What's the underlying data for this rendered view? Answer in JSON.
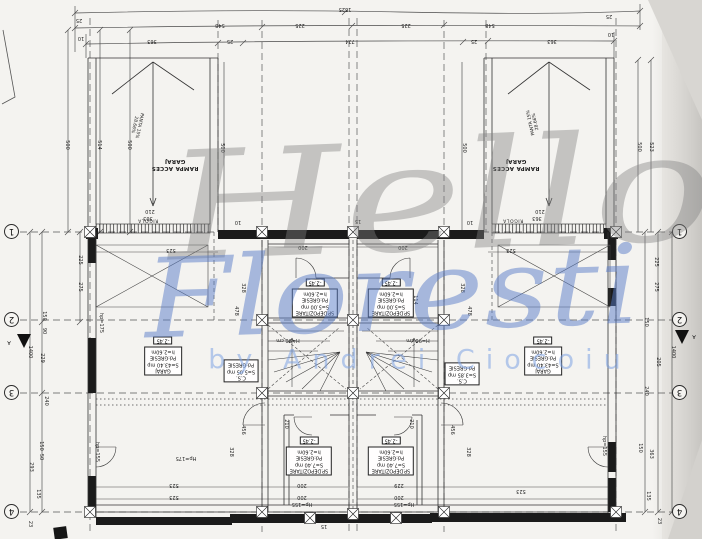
{
  "watermark": {
    "word1": "Hello",
    "word2": "Floresti",
    "byline": "by Andrei Ciocoiu"
  },
  "axes": {
    "left": [
      "1",
      "2",
      "3",
      "4"
    ],
    "right": [
      "1",
      "2",
      "3",
      "4"
    ]
  },
  "ramps": {
    "left": {
      "name1": "RAMPA ACCES",
      "name2": "GARAJ",
      "slope1": "PANTA 15%",
      "slope2": "28.66%",
      "channel": "RIGOLA"
    },
    "right": {
      "name1": "RAMPA ACCES",
      "name2": "GARAJ",
      "slope1": "PANTA 15%",
      "slope2": "28.66%",
      "channel": "RIGOLA"
    }
  },
  "room_labels": [
    {
      "id": "garage-left",
      "x": 163,
      "y": 356,
      "level": "-2.45",
      "lines": [
        "GARAJ",
        "S=43.40 mp",
        "Pd:GRESIE",
        "h=2.60m"
      ]
    },
    {
      "id": "garage-right",
      "x": 543,
      "y": 356,
      "level": "-2.45",
      "lines": [
        "GARAJ",
        "S=43.40 mp",
        "Pd:GRESIE",
        "h=2.60m"
      ]
    },
    {
      "id": "storage-upper-left",
      "x": 315,
      "y": 298,
      "level": "-2.45",
      "lines": [
        "SP.DEPOZITARE",
        "S=5.00 mp",
        "Pd:GRESIE",
        "h=2.60m"
      ]
    },
    {
      "id": "storage-upper-right",
      "x": 391,
      "y": 298,
      "level": "-2.45",
      "lines": [
        "SP.DEPOZITARE",
        "S=5.00 mp",
        "Pd:GRESIE",
        "h=2.60m"
      ]
    },
    {
      "id": "storage-lower-left",
      "x": 309,
      "y": 456,
      "level": "-2.45",
      "lines": [
        "SP.DEPOZITARE",
        "S=7.40 mp",
        "Pd:GRESIE",
        "h=2.60m"
      ]
    },
    {
      "id": "storage-lower-right",
      "x": 391,
      "y": 456,
      "level": "-2.45",
      "lines": [
        "SP.DEPOZITARE",
        "S=7.40 mp",
        "Pd:GRESIE",
        "h=2.60m"
      ]
    },
    {
      "id": "stair-left",
      "x": 241,
      "y": 371,
      "level": "",
      "lines": [
        "C.S.",
        "S=5.05 mp",
        "Pd:GRESIE"
      ]
    },
    {
      "id": "stair-right",
      "x": 462,
      "y": 374,
      "level": "",
      "lines": [
        "C.S.",
        "S=3.85 mp",
        "Pd:GRESIE"
      ]
    }
  ],
  "annotations": [
    {
      "t": "1525",
      "x": 345,
      "y": 9,
      "r": 180
    },
    {
      "t": "25",
      "x": 79,
      "y": 20,
      "r": 180
    },
    {
      "t": "10",
      "x": 81,
      "y": 38,
      "r": 180
    },
    {
      "t": "548",
      "x": 220,
      "y": 25,
      "r": 180
    },
    {
      "t": "225",
      "x": 300,
      "y": 25,
      "r": 180
    },
    {
      "t": "225",
      "x": 406,
      "y": 25,
      "r": 180
    },
    {
      "t": "548",
      "x": 490,
      "y": 25,
      "r": 180
    },
    {
      "t": "363",
      "x": 152,
      "y": 41,
      "r": 180
    },
    {
      "t": "25",
      "x": 230,
      "y": 41,
      "r": 180
    },
    {
      "t": "774",
      "x": 350,
      "y": 41,
      "r": 180
    },
    {
      "t": "25",
      "x": 474,
      "y": 41,
      "r": 180
    },
    {
      "t": "363",
      "x": 552,
      "y": 41,
      "r": 180
    },
    {
      "t": "25",
      "x": 609,
      "y": 16,
      "r": 180
    },
    {
      "t": "10",
      "x": 611,
      "y": 34,
      "r": 180
    },
    {
      "t": "500",
      "x": 67,
      "y": 145,
      "r": 90
    },
    {
      "t": "514",
      "x": 99,
      "y": 145,
      "r": 90
    },
    {
      "t": "500",
      "x": 129,
      "y": 145,
      "r": 90
    },
    {
      "t": "500",
      "x": 222,
      "y": 148,
      "r": 90
    },
    {
      "t": "500",
      "x": 464,
      "y": 148,
      "r": 90
    },
    {
      "t": "500",
      "x": 639,
      "y": 147,
      "r": 90
    },
    {
      "t": "523",
      "x": 651,
      "y": 147,
      "r": 90
    },
    {
      "t": "210",
      "x": 150,
      "y": 211,
      "r": 180
    },
    {
      "t": "363",
      "x": 148,
      "y": 218,
      "r": 180
    },
    {
      "t": "210",
      "x": 540,
      "y": 211,
      "r": 180
    },
    {
      "t": "363",
      "x": 537,
      "y": 218,
      "r": 180
    },
    {
      "t": "225",
      "x": 80,
      "y": 260,
      "r": 90
    },
    {
      "t": "275",
      "x": 80,
      "y": 287,
      "r": 90
    },
    {
      "t": "1400",
      "x": 30,
      "y": 352,
      "r": 90
    },
    {
      "t": "150",
      "x": 44,
      "y": 316,
      "r": 90
    },
    {
      "t": "90",
      "x": 44,
      "y": 331,
      "r": 90
    },
    {
      "t": "229",
      "x": 42,
      "y": 358,
      "r": 90
    },
    {
      "t": "240",
      "x": 46,
      "y": 401,
      "r": 90
    },
    {
      "t": "150",
      "x": 41,
      "y": 446,
      "r": 90
    },
    {
      "t": "50",
      "x": 41,
      "y": 457,
      "r": 90
    },
    {
      "t": "293",
      "x": 31,
      "y": 467,
      "r": 90
    },
    {
      "t": "135",
      "x": 38,
      "y": 494,
      "r": 90
    },
    {
      "t": "23",
      "x": 30,
      "y": 524,
      "r": 90
    },
    {
      "t": "225",
      "x": 656,
      "y": 262,
      "r": 90
    },
    {
      "t": "275",
      "x": 656,
      "y": 287,
      "r": 90
    },
    {
      "t": "1400",
      "x": 673,
      "y": 352,
      "r": 90
    },
    {
      "t": "150",
      "x": 646,
      "y": 322,
      "r": 90
    },
    {
      "t": "205",
      "x": 658,
      "y": 362,
      "r": 90
    },
    {
      "t": "240",
      "x": 646,
      "y": 391,
      "r": 90
    },
    {
      "t": "363",
      "x": 651,
      "y": 454,
      "r": 90
    },
    {
      "t": "150",
      "x": 640,
      "y": 448,
      "r": 90
    },
    {
      "t": "135",
      "x": 648,
      "y": 496,
      "r": 90
    },
    {
      "t": "23",
      "x": 659,
      "y": 521,
      "r": 90
    },
    {
      "t": "523",
      "x": 171,
      "y": 250,
      "r": 180
    },
    {
      "t": "523",
      "x": 511,
      "y": 250,
      "r": 180
    },
    {
      "t": "523",
      "x": 174,
      "y": 485,
      "r": 180
    },
    {
      "t": "523",
      "x": 174,
      "y": 497,
      "r": 180
    },
    {
      "t": "523",
      "x": 521,
      "y": 491,
      "r": 180
    },
    {
      "t": "200",
      "x": 303,
      "y": 247,
      "r": 180
    },
    {
      "t": "200",
      "x": 403,
      "y": 247,
      "r": 180
    },
    {
      "t": "200",
      "x": 302,
      "y": 485,
      "r": 180
    },
    {
      "t": "200",
      "x": 302,
      "y": 497,
      "r": 180
    },
    {
      "t": "229",
      "x": 399,
      "y": 485,
      "r": 180
    },
    {
      "t": "200",
      "x": 399,
      "y": 497,
      "r": 180
    },
    {
      "t": "456",
      "x": 243,
      "y": 430,
      "r": 90
    },
    {
      "t": "456",
      "x": 452,
      "y": 430,
      "r": 90
    },
    {
      "t": "328",
      "x": 231,
      "y": 452,
      "r": 90
    },
    {
      "t": "328",
      "x": 468,
      "y": 452,
      "r": 90
    },
    {
      "t": "328",
      "x": 243,
      "y": 288,
      "r": 90
    },
    {
      "t": "328",
      "x": 462,
      "y": 288,
      "r": 90
    },
    {
      "t": "478",
      "x": 236,
      "y": 311,
      "r": 90
    },
    {
      "t": "478",
      "x": 469,
      "y": 311,
      "r": 90
    },
    {
      "t": "114",
      "x": 415,
      "y": 300,
      "r": 90
    },
    {
      "t": "210",
      "x": 286,
      "y": 424,
      "r": 90
    },
    {
      "t": "210",
      "x": 411,
      "y": 424,
      "r": 90
    },
    {
      "t": "Hp=175",
      "x": 186,
      "y": 458,
      "r": 180
    },
    {
      "t": "Hp=155",
      "x": 302,
      "y": 504,
      "r": 180
    },
    {
      "t": "Hp=155",
      "x": 404,
      "y": 504,
      "r": 180
    },
    {
      "t": "hp=175",
      "x": 101,
      "y": 323,
      "r": 90
    },
    {
      "t": "hp=155",
      "x": 97,
      "y": 452,
      "r": 90
    },
    {
      "t": "hp=155",
      "x": 604,
      "y": 446,
      "r": 90
    },
    {
      "t": "H=90 cm",
      "x": 288,
      "y": 340,
      "r": 180
    },
    {
      "t": "H=90 cm",
      "x": 418,
      "y": 340,
      "r": 180
    },
    {
      "t": "10",
      "x": 238,
      "y": 222,
      "r": 180
    },
    {
      "t": "15",
      "x": 358,
      "y": 221,
      "r": 180
    },
    {
      "t": "10",
      "x": 470,
      "y": 222,
      "r": 180
    },
    {
      "t": "15",
      "x": 324,
      "y": 526,
      "r": 180
    },
    {
      "t": "10",
      "x": 236,
      "y": 516,
      "r": 180
    },
    {
      "t": "10",
      "x": 468,
      "y": 516,
      "r": 180
    },
    {
      "t": "A",
      "x": 9,
      "y": 342,
      "r": 180
    },
    {
      "t": "A",
      "x": 694,
      "y": 336,
      "r": 180
    }
  ]
}
